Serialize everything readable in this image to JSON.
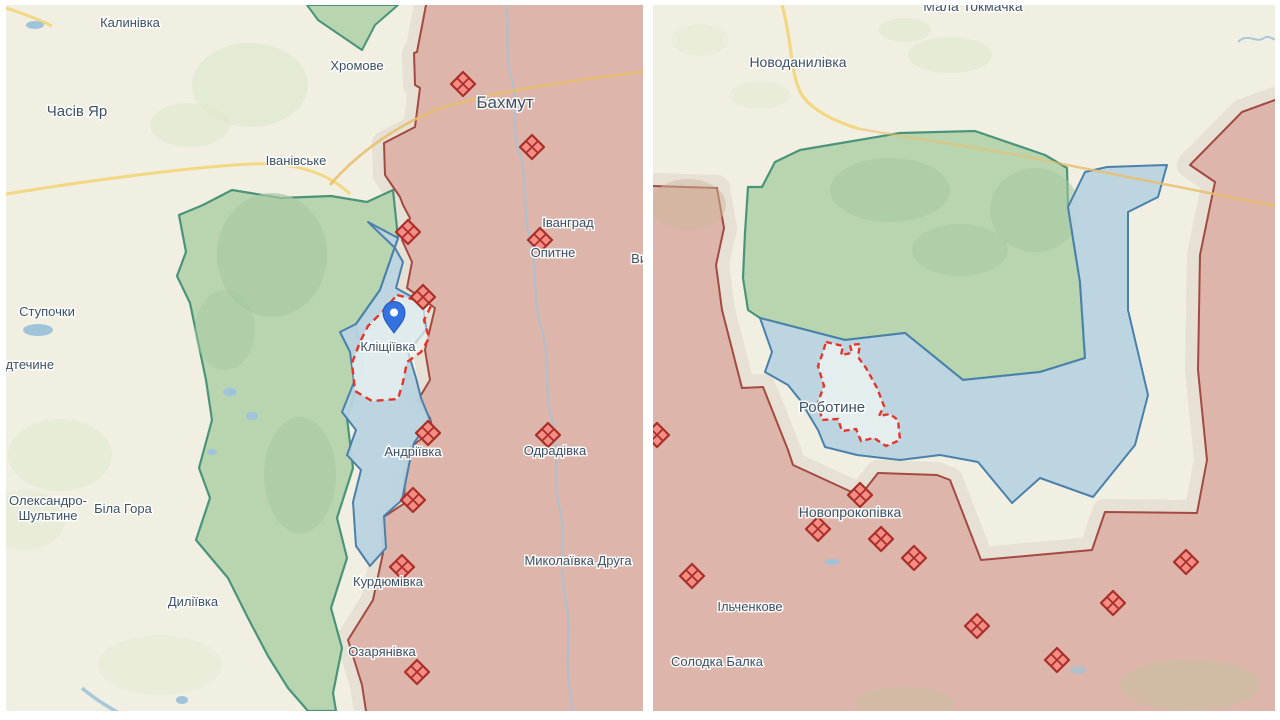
{
  "colors": {
    "map_bg": "#f1eee2",
    "divider": "#ffffff",
    "occupied_fill": "#ddb5ab",
    "frontline": "#a34a42",
    "liberated_green_fill": "#b8d5b0",
    "liberated_green_line": "#4a9479",
    "recent_blue_fill": "#b9d3df",
    "recent_blue_line": "#4a81ac",
    "gray_zone": "#e7e0d4",
    "village_fill": "#eef4f2",
    "village_dash": "#e4352b",
    "diamond_fill": "#f58c86",
    "diamond_stroke": "#a93029",
    "pin_fill": "#3471e1",
    "pin_stroke": "#2458b8",
    "label_text": "#3d5266",
    "road_yellow": "#f2d883",
    "road_orange": "#e9bd6a",
    "water": "#9fc4da"
  },
  "maps": [
    {
      "id": "left",
      "dashed_settlement": "Кліщіївка",
      "labels": [
        {
          "text": "Калинівка",
          "x": 130,
          "y": 27,
          "size": 13
        },
        {
          "text": "Часів Яр",
          "x": 77,
          "y": 116,
          "size": 15
        },
        {
          "text": "Хромове",
          "x": 357,
          "y": 70,
          "size": 13
        },
        {
          "text": "Бахмут",
          "x": 505,
          "y": 108,
          "size": 17
        },
        {
          "text": "Іванівське",
          "x": 296,
          "y": 165,
          "size": 13
        },
        {
          "text": "Іванград",
          "x": 568,
          "y": 227,
          "size": 13
        },
        {
          "text": "Опитне",
          "x": 553,
          "y": 257,
          "size": 13
        },
        {
          "text": "Ступочки",
          "x": 47,
          "y": 316,
          "size": 13
        },
        {
          "text": "Предтечине",
          "x": 18,
          "y": 369,
          "size": 13
        },
        {
          "text": "Кліщіївка",
          "x": 388,
          "y": 351,
          "size": 13
        },
        {
          "text": "Олександро-",
          "x": 48,
          "y": 505,
          "size": 13
        },
        {
          "text": "Шультине",
          "x": 48,
          "y": 520,
          "size": 13
        },
        {
          "text": "Біла Гора",
          "x": 123,
          "y": 513,
          "size": 13
        },
        {
          "text": "Андріївка",
          "x": 413,
          "y": 456,
          "size": 13
        },
        {
          "text": "Одрадівка",
          "x": 555,
          "y": 455,
          "size": 13
        },
        {
          "text": "Миколаївка Друга",
          "x": 578,
          "y": 565,
          "size": 13
        },
        {
          "text": "Курдюмівка",
          "x": 388,
          "y": 586,
          "size": 13
        },
        {
          "text": "Диліївка",
          "x": 193,
          "y": 606,
          "size": 13
        },
        {
          "text": "Озарянівка",
          "x": 382,
          "y": 656,
          "size": 13
        },
        {
          "text": "Виїмка",
          "x": 652,
          "y": 263,
          "size": 13
        }
      ],
      "diamonds": [
        [
          463,
          84
        ],
        [
          532,
          147
        ],
        [
          540,
          240
        ],
        [
          408,
          232
        ],
        [
          423,
          297
        ],
        [
          428,
          433
        ],
        [
          548,
          435
        ],
        [
          413,
          500
        ],
        [
          402,
          567
        ],
        [
          417,
          672
        ]
      ],
      "pin": {
        "x": 394,
        "y": 333
      }
    },
    {
      "id": "right",
      "dashed_settlement": "Роботине",
      "labels": [
        {
          "text": "Мала Токмачка",
          "x": 973,
          "y": 11,
          "size": 14
        },
        {
          "text": "Новоданилівка",
          "x": 798,
          "y": 67,
          "size": 14
        },
        {
          "text": "Роботине",
          "x": 832,
          "y": 412,
          "size": 15
        },
        {
          "text": "Новопрокопівка",
          "x": 850,
          "y": 517,
          "size": 14
        },
        {
          "text": "Ільченкове",
          "x": 750,
          "y": 611,
          "size": 13
        },
        {
          "text": "Солодка Балка",
          "x": 717,
          "y": 666,
          "size": 13
        }
      ],
      "diamonds": [
        [
          657,
          435
        ],
        [
          860,
          495
        ],
        [
          818,
          529
        ],
        [
          881,
          539
        ],
        [
          914,
          558
        ],
        [
          692,
          576
        ],
        [
          1186,
          562
        ],
        [
          1113,
          603
        ],
        [
          977,
          626
        ],
        [
          1057,
          660
        ]
      ],
      "pin": null
    }
  ]
}
